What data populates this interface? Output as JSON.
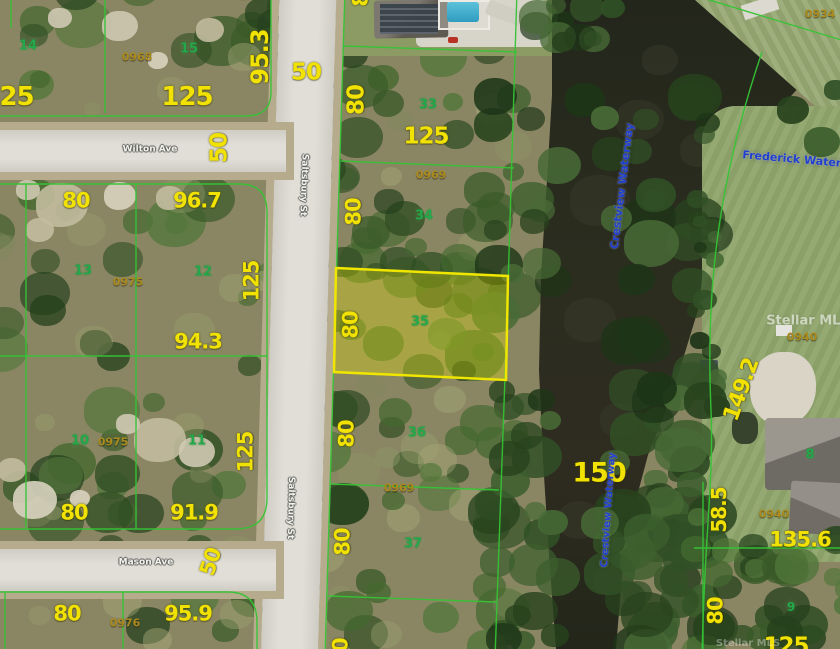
{
  "map": {
    "type": "aerial-parcel-map",
    "subject_lot": "35",
    "highlight_color": "#f0e600",
    "parcel_line_color": "#35c435",
    "streets": [
      "Wilton Ave",
      "Mason Ave",
      "Saltsbury St"
    ],
    "waterways": [
      "Crestview Waterway",
      "Frederick Waterway"
    ],
    "watermark": "Stellar MLS"
  },
  "labels": [
    {
      "kind": "dim",
      "text": "125",
      "x": 8,
      "y": 97,
      "rot": 0,
      "size": 26
    },
    {
      "kind": "dim",
      "text": "125",
      "x": 187,
      "y": 97,
      "rot": 0,
      "size": 26
    },
    {
      "kind": "dim",
      "text": "95.3",
      "x": 260,
      "y": 57,
      "rot": -90,
      "size": 24
    },
    {
      "kind": "dim",
      "text": "50",
      "x": 220,
      "y": 148,
      "rot": -90,
      "size": 23
    },
    {
      "kind": "dim",
      "text": "50",
      "x": 306,
      "y": 73,
      "rot": 0,
      "size": 23
    },
    {
      "kind": "dim",
      "text": "80",
      "x": 357,
      "y": 100,
      "rot": -90,
      "size": 23
    },
    {
      "kind": "dim",
      "text": "125",
      "x": 426,
      "y": 137,
      "rot": 0,
      "size": 23
    },
    {
      "kind": "dim",
      "text": "80",
      "x": 76,
      "y": 201,
      "rot": 0,
      "size": 21
    },
    {
      "kind": "dim",
      "text": "96.7",
      "x": 197,
      "y": 201,
      "rot": 0,
      "size": 21
    },
    {
      "kind": "dim",
      "text": "125",
      "x": 252,
      "y": 281,
      "rot": -90,
      "size": 21
    },
    {
      "kind": "dim",
      "text": "94.3",
      "x": 198,
      "y": 342,
      "rot": 0,
      "size": 21
    },
    {
      "kind": "dim",
      "text": "80",
      "x": 354,
      "y": 212,
      "rot": -90,
      "size": 21
    },
    {
      "kind": "dim",
      "text": "80",
      "x": 351,
      "y": 325,
      "rot": -90,
      "size": 21
    },
    {
      "kind": "dim",
      "text": "80",
      "x": 347,
      "y": 434,
      "rot": -90,
      "size": 21
    },
    {
      "kind": "dim",
      "text": "80",
      "x": 343,
      "y": 542,
      "rot": -90,
      "size": 21
    },
    {
      "kind": "dim",
      "text": "125",
      "x": 246,
      "y": 452,
      "rot": -90,
      "size": 21
    },
    {
      "kind": "dim",
      "text": "80",
      "x": 74,
      "y": 513,
      "rot": 0,
      "size": 21
    },
    {
      "kind": "dim",
      "text": "91.9",
      "x": 194,
      "y": 513,
      "rot": 0,
      "size": 21
    },
    {
      "kind": "dim",
      "text": "50",
      "x": 211,
      "y": 562,
      "rot": -72,
      "size": 21
    },
    {
      "kind": "dim",
      "text": "80",
      "x": 67,
      "y": 614,
      "rot": 0,
      "size": 21
    },
    {
      "kind": "dim",
      "text": "95.9",
      "x": 188,
      "y": 614,
      "rot": 0,
      "size": 21
    },
    {
      "kind": "dim",
      "text": "150",
      "x": 599,
      "y": 473,
      "rot": 0,
      "size": 27
    },
    {
      "kind": "dim",
      "text": "149.2",
      "x": 742,
      "y": 390,
      "rot": -70,
      "size": 22
    },
    {
      "kind": "dim",
      "text": "58.5",
      "x": 719,
      "y": 510,
      "rot": -90,
      "size": 20
    },
    {
      "kind": "dim",
      "text": "135.6",
      "x": 800,
      "y": 540,
      "rot": 0,
      "size": 21
    },
    {
      "kind": "dim",
      "text": "80",
      "x": 716,
      "y": 611,
      "rot": -90,
      "size": 21
    },
    {
      "kind": "dim",
      "text": "125",
      "x": 786,
      "y": 647,
      "rot": 0,
      "size": 23
    },
    {
      "kind": "dim",
      "text": "80",
      "x": 341,
      "y": 652,
      "rot": -90,
      "size": 21
    },
    {
      "kind": "dim",
      "text": "80",
      "x": 361,
      "y": -7,
      "rot": -90,
      "size": 21
    },
    {
      "kind": "dim",
      "text": "50",
      "x": 250,
      "y": -8,
      "rot": 0,
      "size": 21
    },
    {
      "kind": "lot",
      "text": "14",
      "x": 28,
      "y": 46,
      "rot": 0,
      "size": 13
    },
    {
      "kind": "lot",
      "text": "15",
      "x": 189,
      "y": 49,
      "rot": 0,
      "size": 13
    },
    {
      "kind": "lot",
      "text": "13",
      "x": 83,
      "y": 271,
      "rot": 0,
      "size": 13
    },
    {
      "kind": "lot",
      "text": "12",
      "x": 203,
      "y": 272,
      "rot": 0,
      "size": 13
    },
    {
      "kind": "lot",
      "text": "10",
      "x": 80,
      "y": 441,
      "rot": 0,
      "size": 13
    },
    {
      "kind": "lot",
      "text": "11",
      "x": 197,
      "y": 441,
      "rot": 0,
      "size": 13
    },
    {
      "kind": "lot",
      "text": "33",
      "x": 428,
      "y": 105,
      "rot": 0,
      "size": 13
    },
    {
      "kind": "lot",
      "text": "34",
      "x": 424,
      "y": 216,
      "rot": 0,
      "size": 13
    },
    {
      "kind": "lot",
      "text": "35",
      "x": 420,
      "y": 322,
      "rot": 0,
      "size": 13
    },
    {
      "kind": "lot",
      "text": "36",
      "x": 417,
      "y": 433,
      "rot": 0,
      "size": 13
    },
    {
      "kind": "lot",
      "text": "37",
      "x": 413,
      "y": 544,
      "rot": 0,
      "size": 13
    },
    {
      "kind": "lot",
      "text": "8",
      "x": 810,
      "y": 455,
      "rot": 0,
      "size": 13
    },
    {
      "kind": "lot",
      "text": "9",
      "x": 791,
      "y": 607,
      "rot": 0,
      "size": 12
    },
    {
      "kind": "pid",
      "text": "0968",
      "x": 137,
      "y": 57,
      "rot": 0,
      "size": 11
    },
    {
      "kind": "pid",
      "text": "0969",
      "x": 431,
      "y": 175,
      "rot": 0,
      "size": 11
    },
    {
      "kind": "pid",
      "text": "0975",
      "x": 128,
      "y": 282,
      "rot": 0,
      "size": 11
    },
    {
      "kind": "pid",
      "text": "0975",
      "x": 113,
      "y": 442,
      "rot": 0,
      "size": 11
    },
    {
      "kind": "pid",
      "text": "0969",
      "x": 399,
      "y": 488,
      "rot": 0,
      "size": 11
    },
    {
      "kind": "pid",
      "text": "0934",
      "x": 820,
      "y": 14,
      "rot": 0,
      "size": 11
    },
    {
      "kind": "pid",
      "text": "0940",
      "x": 802,
      "y": 337,
      "rot": 0,
      "size": 11
    },
    {
      "kind": "pid",
      "text": "0940",
      "x": 774,
      "y": 514,
      "rot": 0,
      "size": 11
    },
    {
      "kind": "pid",
      "text": "0976",
      "x": 125,
      "y": 623,
      "rot": 0,
      "size": 11
    },
    {
      "kind": "street",
      "text": "Wilton Ave",
      "x": 150,
      "y": 150,
      "rot": 0,
      "size": 9
    },
    {
      "kind": "street",
      "text": "Mason Ave",
      "x": 146,
      "y": 563,
      "rot": 0,
      "size": 9
    },
    {
      "kind": "street",
      "text": "Saltsbury St",
      "x": 303,
      "y": 185,
      "rot": 92,
      "size": 9
    },
    {
      "kind": "street",
      "text": "Saltsbury St",
      "x": 290,
      "y": 508,
      "rot": 91,
      "size": 9
    },
    {
      "kind": "waterway",
      "text": "Frederick Waterway",
      "x": 804,
      "y": 160,
      "rot": 5,
      "size": 11
    },
    {
      "kind": "waterway",
      "text": "Crestview Waterway",
      "x": 622,
      "y": 186,
      "rot": -83,
      "size": 11
    },
    {
      "kind": "waterway",
      "text": "Crestview Waterway",
      "x": 609,
      "y": 510,
      "rot": -86,
      "size": 10
    },
    {
      "kind": "wm",
      "text": "Stellar MLS",
      "x": 808,
      "y": 321,
      "rot": 0,
      "size": 13,
      "op": 0.55
    },
    {
      "kind": "wm",
      "text": "Stellar MLS",
      "x": 748,
      "y": 644,
      "rot": 0,
      "size": 10,
      "op": 0.35
    }
  ]
}
